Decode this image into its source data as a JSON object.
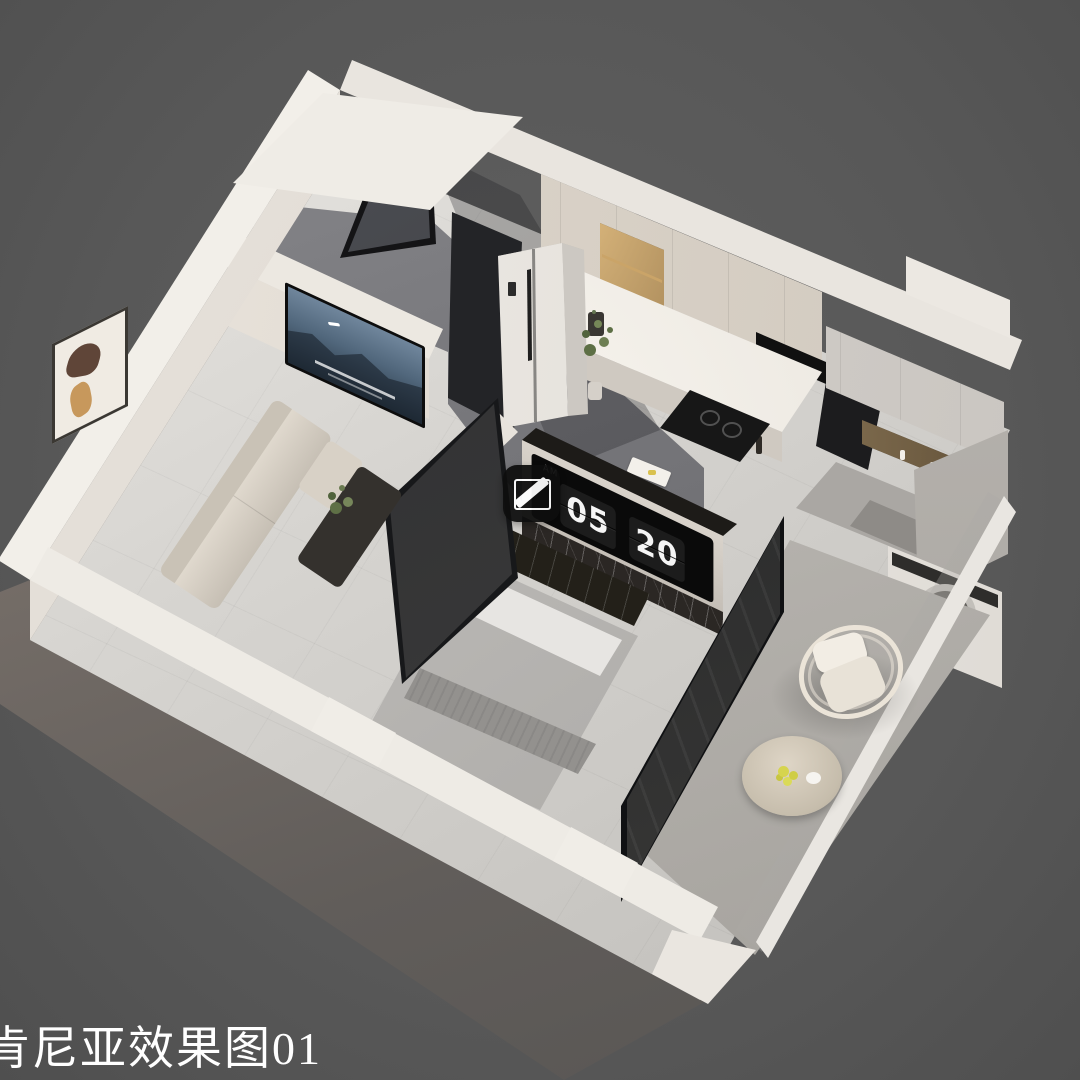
{
  "caption": {
    "text": "肯尼亚效果图01"
  },
  "clock": {
    "meridiem": "AM",
    "hour": "05",
    "minute": "20"
  },
  "icons": {
    "watermark": "slash-icon"
  },
  "colors": {
    "background": "#5a5a5a",
    "wall_top": "#efece6",
    "wall_cream": "#e7e1d9",
    "floor_light": "#d8d5d0",
    "bathroom_concrete": "#77777b",
    "marble_dark": "#2b2724",
    "clock_panel": "#0a0a0a",
    "niche_glow": "#f3cf8f"
  }
}
